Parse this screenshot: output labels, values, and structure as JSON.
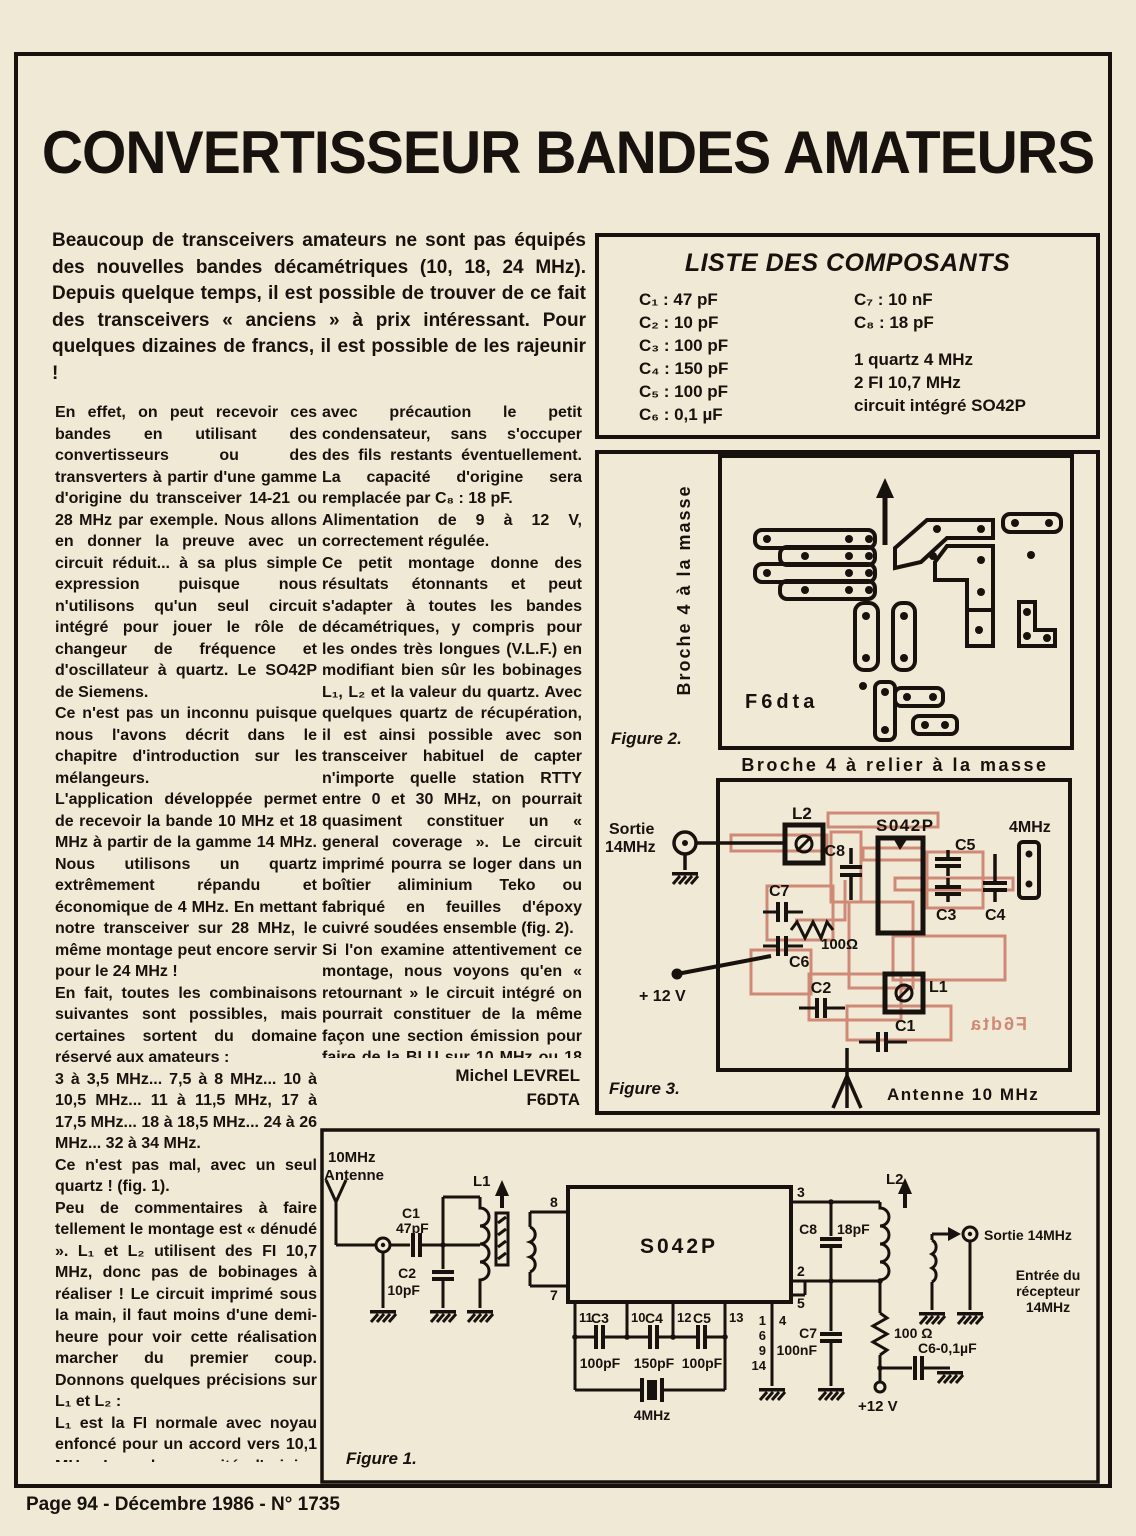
{
  "page": {
    "title": "CONVERTISSEUR BANDES AMATEURS",
    "footer": "Page 94 - Décembre 1986 - N° 1735"
  },
  "intro": "Beaucoup de transceivers amateurs ne sont pas équipés des nouvelles bandes décamétriques (10, 18, 24 MHz). Depuis quelque temps, il est possible de trouver de ce fait des transceivers « anciens » à prix intéressant. Pour quelques dizaines de francs, il est possible de les rajeunir !",
  "components": {
    "title": "LISTE DES COMPOSANTS",
    "left": [
      "C₁ : 47 pF",
      "C₂ : 10 pF",
      "C₃ : 100 pF",
      "C₄ : 150 pF",
      "C₅ : 100 pF",
      "C₆ : 0,1 µF"
    ],
    "right_caps": [
      "C₇ : 10 nF",
      "C₈ : 18 pF"
    ],
    "right_misc": [
      "1 quartz 4 MHz",
      "2 FI 10,7 MHz",
      "circuit intégré SO42P"
    ]
  },
  "col_left": {
    "paragraphs": [
      "En effet, on peut recevoir ces bandes en utilisant des convertisseurs ou des transverters à partir d'une gamme d'origine du transceiver 14-21 ou 28 MHz par exemple. Nous allons en donner la preuve avec un circuit réduit... à sa plus simple expression puisque nous n'utilisons qu'un seul circuit intégré pour jouer le rôle de changeur de fréquence et d'oscillateur à quartz. Le SO42P de Siemens.",
      "Ce n'est pas un inconnu puisque nous l'avons décrit dans le chapitre d'introduction sur les mélangeurs.",
      "L'application développée permet de recevoir la bande 10 MHz et 18 MHz à partir de la gamme 14 MHz. Nous utilisons un quartz extrêmement répandu et économique de 4 MHz. En mettant notre transceiver sur 28 MHz, le même montage peut encore servir pour le 24 MHz !",
      "En fait, toutes les combinaisons suivantes sont possibles, mais certaines sortent du domaine réservé aux amateurs :",
      "3 à 3,5 MHz... 7,5 à 8 MHz... 10 à 10,5 MHz... 11 à 11,5 MHz, 17 à 17,5 MHz... 18 à 18,5 MHz... 24 à 26 MHz... 32 à 34 MHz.",
      "Ce n'est pas mal, avec un seul quartz ! (fig. 1).",
      "Peu de commentaires à faire tellement le montage est « dénudé ». L₁ et L₂ utilisent des FI 10,7 MHz, donc pas de bobinages à réaliser ! Le circuit imprimé sous la main, il faut moins d'une demi-heure pour voir cette réalisation marcher du premier coup. Donnons quelques précisions sur L₁ et L₂ :",
      "L₁ est la FI normale avec noyau enfoncé pour un accord vers 10,1 MHz. L₂ a la capacité d'origine enlevée. Pour ce faire, prendre le plus petit tournevis de votre collection (type tournevis métallique d'horloger), casser"
    ]
  },
  "col_mid": {
    "paragraphs": [
      "avec précaution le petit condensateur, sans s'occuper des fils restants éventuellement. La capacité d'origine sera remplacée par C₈ : 18 pF.",
      "Alimentation de 9 à 12 V, correctement régulée.",
      "Ce petit montage donne des résultats étonnants et peut s'adapter à toutes les bandes décamétriques, y compris pour les ondes très longues (V.L.F.) en modifiant bien sûr les bobinages L₁, L₂ et la valeur du quartz. Avec quelques quartz de récupération, il est ainsi possible avec son transceiver habituel de capter n'importe quelle station RTTY entre 0 et 30 MHz, on pourrait quasiment constituer un « general coverage ». Le circuit imprimé pourra se loger dans un boîtier aliminium Teko ou fabriqué en feuilles d'époxy cuivré soudées ensemble (fig. 2).",
      "Si l'on examine attentivement ce montage, nous voyons qu'en « retournant » le circuit intégré on pourrait constituer de la même façon une section émission pour faire de la BLU sur 10 MHz ou 18 MHz.",
      "A vos fers à souder..."
    ],
    "signature_name": "Michel LEVREL",
    "signature_call": "F6DTA"
  },
  "fig2": {
    "vertical_label": "Broche 4 à la masse",
    "board_label": "F6dta",
    "caption": "Figure 2.",
    "bottom_label": "Broche 4 à relier à la masse"
  },
  "fig3": {
    "caption": "Figure 3.",
    "sortie1": "Sortie",
    "sortie2": "14MHz",
    "l2": "L2",
    "ic": "S042P",
    "xtal": "4MHz",
    "c8": "C8",
    "c5": "C5",
    "c7": "C7",
    "c3": "C3",
    "c4": "C4",
    "c6": "C6",
    "r100": "100Ω",
    "plus12": "+ 12 V",
    "c2": "C2",
    "l1": "L1",
    "c1": "C1",
    "mirror": "F6dta",
    "antenne": "Antenne  10 MHz"
  },
  "fig1": {
    "caption": "Figure 1.",
    "ant1": "10MHz",
    "ant2": "Antenne",
    "c1": "C1",
    "c1v": "47pF",
    "c2": "C2",
    "c2v": "10pF",
    "l1": "L1",
    "p8": "8",
    "p7": "7",
    "ic": "S042P",
    "p3": "3",
    "p2": "2",
    "p5": "5",
    "p11": "11",
    "p10": "10",
    "p12": "12",
    "p13": "13",
    "g1": "1",
    "g6": "6",
    "g9": "9",
    "g14": "14",
    "p4": "4",
    "c3": "C3",
    "c3v": "100pF",
    "c4": "C4",
    "c4v": "150pF",
    "c5": "C5",
    "c5v": "100pF",
    "xtal": "4MHz",
    "c8": "C8",
    "c8v": "18pF",
    "l2": "L2",
    "c7": "C7",
    "c7v": "100nF",
    "r100": "100 Ω",
    "c6": "C6-0,1µF",
    "plus12": "+12 V",
    "sortie": "Sortie 14MHz",
    "in1": "Entrée du",
    "in2": "récepteur",
    "in3": "14MHz"
  }
}
